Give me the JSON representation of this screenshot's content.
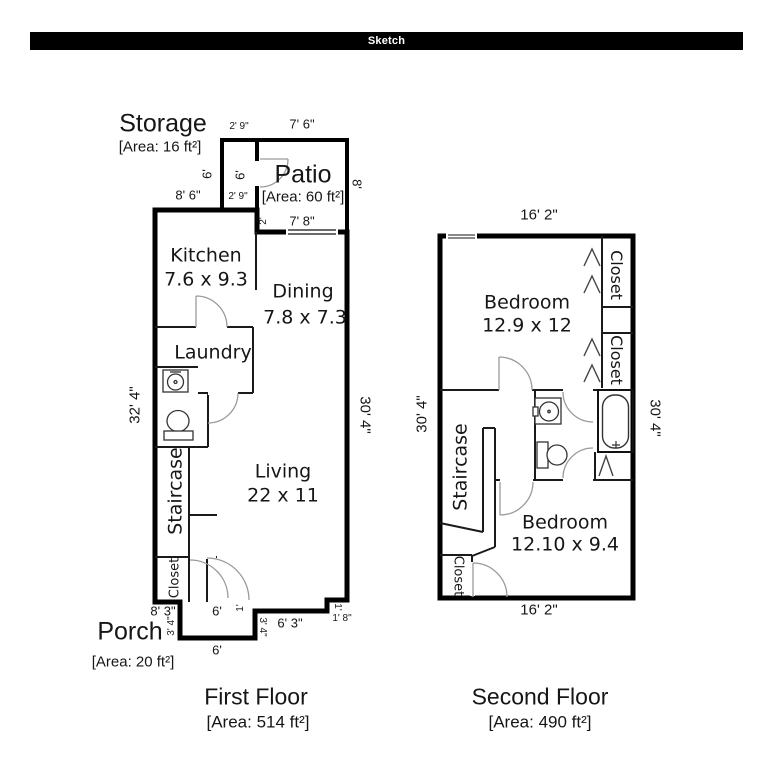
{
  "header": {
    "title": "Sketch"
  },
  "floor1": {
    "title": "First Floor",
    "area": "[Area: 514 ft²]",
    "rooms": {
      "storage": {
        "name": "Storage",
        "area": "[Area: 16 ft²]"
      },
      "patio": {
        "name": "Patio",
        "area": "[Area: 60 ft²]"
      },
      "kitchen": {
        "name": "Kitchen",
        "size": "7.6 x 9.3"
      },
      "dining": {
        "name": "Dining",
        "size": "7.8 x 7.3"
      },
      "laundry": {
        "name": "Laundry"
      },
      "living": {
        "name": "Living",
        "size": "22 x 11"
      },
      "staircase": {
        "name": "Staircase"
      },
      "closet": {
        "name": "Closet"
      },
      "porch": {
        "name": "Porch",
        "area": "[Area: 20 ft²]"
      }
    },
    "dims": {
      "storage_top": "2' 9\"",
      "patio_top": "7' 6\"",
      "storage_left": "6'",
      "storage_inner": "6'",
      "kitchen_top": "8' 6\"",
      "storage_bottom": "2' 9\"",
      "patio_right": "8'",
      "patio_bottom_left": "2'",
      "patio_bottom": "7' 8\"",
      "left_side": "32' 4\"",
      "right_side": "30' 4\"",
      "bottom_left": "8' 3\"",
      "porch_top": "6'",
      "porch_top_right": "1'",
      "porch_left": "3' 4\"",
      "porch_right": "3' 4\"",
      "bottom_mid": "6' 3\"",
      "notch_step": "1'",
      "notch_bottom": "1' 8\"",
      "porch_bottom": "6'"
    }
  },
  "floor2": {
    "title": "Second Floor",
    "area": "[Area: 490 ft²]",
    "rooms": {
      "bedroom1": {
        "name": "Bedroom",
        "size": "12.9 x 12"
      },
      "bedroom2": {
        "name": "Bedroom",
        "size": "12.10 x 9.4"
      },
      "closet_top": {
        "name": "Closet"
      },
      "closet_mid": {
        "name": "Closet"
      },
      "closet_bottom": {
        "name": "Closet"
      },
      "staircase": {
        "name": "Staircase"
      }
    },
    "dims": {
      "top": "16' 2\"",
      "bottom": "16' 2\"",
      "left_side": "30' 4\"",
      "right_side": "30' 4\""
    }
  }
}
